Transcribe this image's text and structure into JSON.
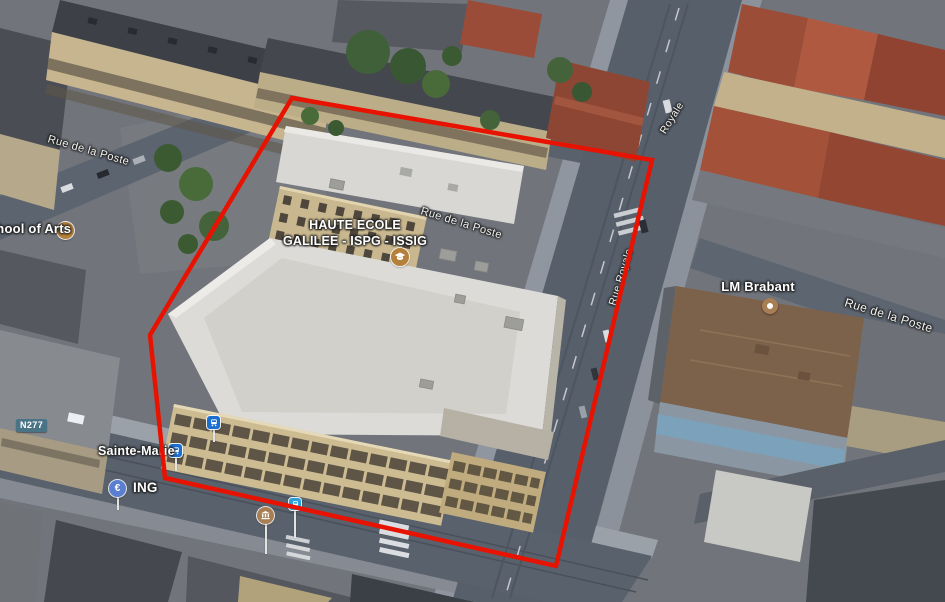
{
  "map": {
    "view": "3d-aerial-satellite",
    "overlay": {
      "polygon_points": "292,98 652,160 556,566 165,478 150,335",
      "stroke_color": "#e81200",
      "stroke_width": 4.5
    },
    "labels": {
      "school_of_arts": "School of Arts",
      "haute_ecole_line1": "HAUTE ECOLE",
      "haute_ecole_line2": "GALILEE - ISPG - ISSIG",
      "lm_brabant": "LM Brabant",
      "ing": "ING",
      "sainte_marie": "Sainte-Marie",
      "n277": "N277",
      "euro_symbol": "€",
      "streets": [
        "Rue de la Poste",
        "Rue de la Poste",
        "Rue de la Poste",
        "Rue Royale",
        "Royale"
      ]
    },
    "icons": {
      "school_of_arts": "graduation-cap-icon",
      "haute_ecole": "graduation-cap-icon",
      "lm_brabant": "poi-dot-icon",
      "ing": "euro-pin-icon",
      "bank_building": "classical-building-pin-icon",
      "sainte_marie_stop": "tram-icon",
      "tram_stop_2": "tram-icon",
      "transit_stop_3": "bus-icon"
    },
    "colors": {
      "red_outline": "#e81200",
      "school_icon": "#b5803a",
      "poi_dot": "#a87f55",
      "bank_pin": "#a87f55",
      "transit_blue": "#1a6ed0",
      "transit_cyan": "#2b9fd8",
      "euro_pin_blue": "#5b7fd0",
      "route_badge": "#4b7386"
    }
  }
}
